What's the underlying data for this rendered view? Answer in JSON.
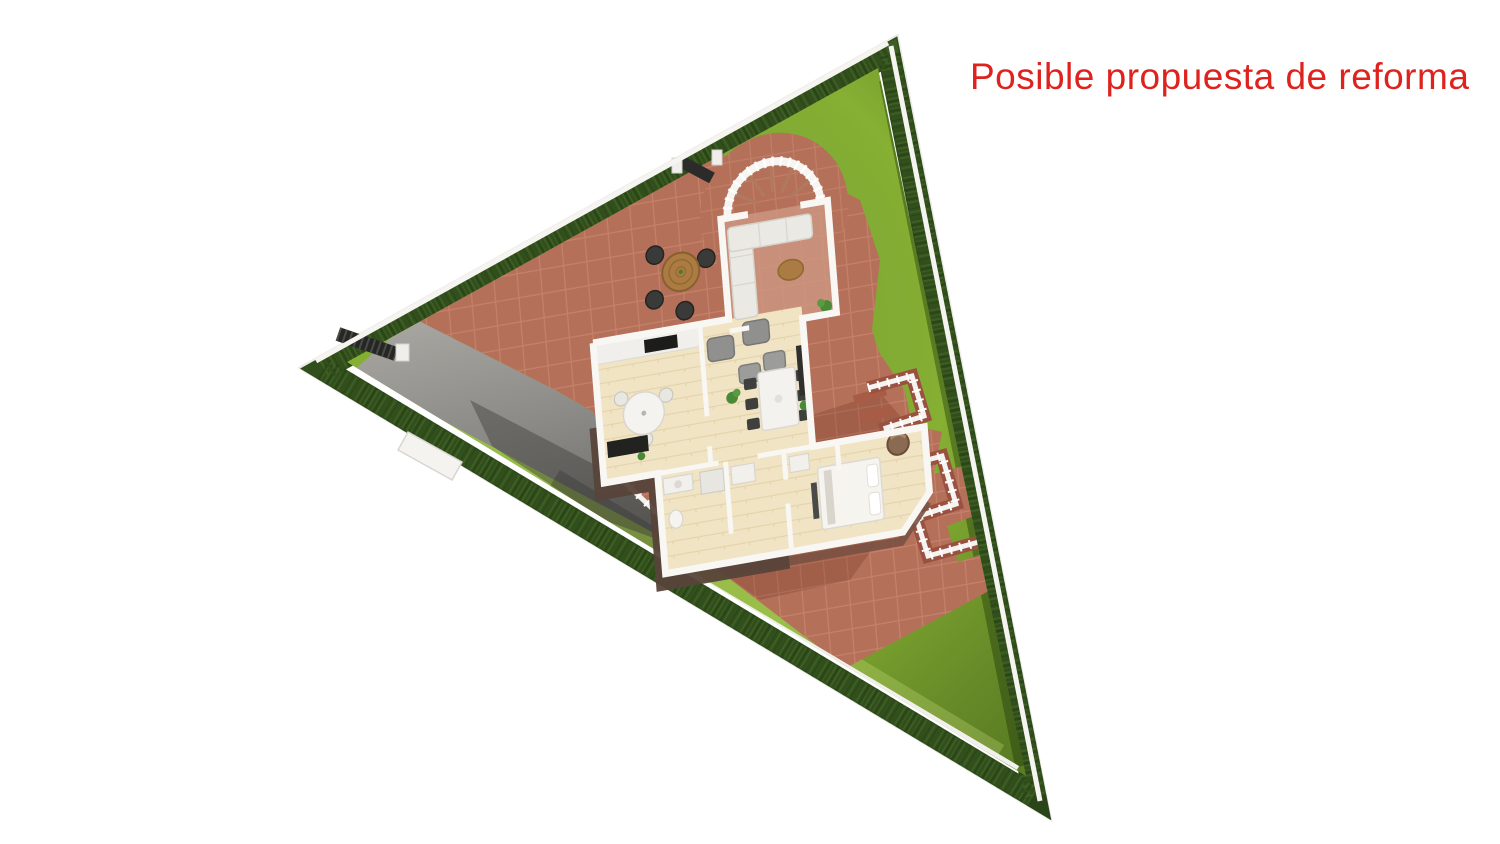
{
  "annotation": {
    "label": "Posible propuesta de reforma",
    "color": "#de231f"
  },
  "plot": {
    "shape": "triangular-parcel-3d-top-view",
    "features": [
      "perimeter-hedge",
      "boundary-wall",
      "lawn",
      "paved-terrace",
      "driveway",
      "driveway-gate",
      "pedestrian-gate",
      "curved-entry-stair",
      "terrace-balustrade",
      "brick-steps"
    ]
  },
  "house": {
    "rooms": [
      "porch-lounge",
      "living-room",
      "kitchen",
      "dining-area",
      "hallway",
      "bathroom",
      "bedroom"
    ],
    "furniture": [
      "outdoor-round-table",
      "outdoor-chairs",
      "white-corner-sofa",
      "coffee-table",
      "gray-armchairs",
      "gray-ottomans",
      "kitchen-round-table",
      "kitchen-counter",
      "cooktop",
      "media-cabinet",
      "dining-table",
      "dining-chairs",
      "sideboard",
      "bathroom-vanity",
      "shower",
      "bed",
      "bedroom-armchair",
      "house-plants"
    ]
  },
  "colors": {
    "title": "#de231f",
    "grass": "#85b033",
    "hedge": "#314f1c",
    "hedge_light": "#4a6f2b",
    "wall": "#edebe6",
    "terracotta": "#b5705a",
    "tile_line": "#d8977b",
    "driveway": "#a19f9b",
    "driveway_shadow": "#55544f",
    "floor": "#f0e4c4",
    "porch_floor": "#c8907a",
    "wall_white": "#f8f7f3",
    "dark_wall": "#57433a",
    "sofa": "#ebe9e4",
    "gray_seat": "#90908e",
    "dark": "#3a3a38",
    "wood": "#aa7b42",
    "plant": "#4a8a36",
    "bed": "#f6f4ef",
    "brown_chair": "#8a6b52"
  }
}
